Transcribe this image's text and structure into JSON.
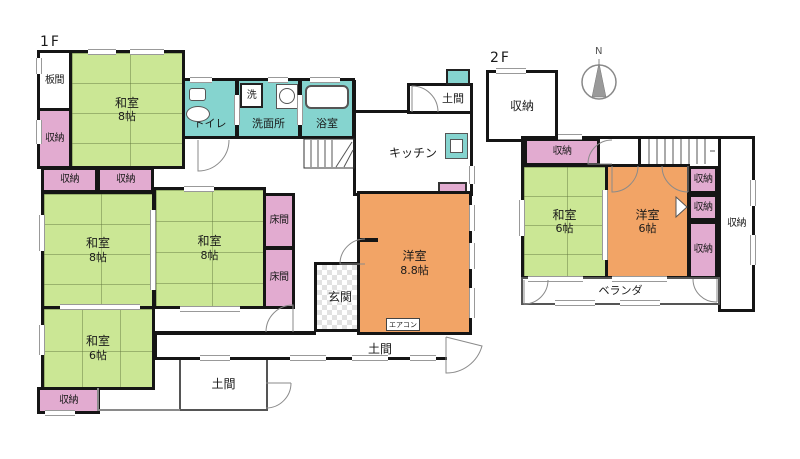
{
  "floor1": {
    "label": "1F",
    "rooms": {
      "itanoma": {
        "name": "板間"
      },
      "washitsu8_top": {
        "name": "和室",
        "size": "8帖"
      },
      "storage_left": {
        "name": "収納"
      },
      "toilet": {
        "name": "トイレ"
      },
      "laundry": {
        "name": "洗"
      },
      "washroom": {
        "name": "洗面所"
      },
      "bathroom": {
        "name": "浴室"
      },
      "kitchen": {
        "name": "キッチン"
      },
      "doma_entry": {
        "name": "土間"
      },
      "storage_a": {
        "name": "収納"
      },
      "storage_b": {
        "name": "収納"
      },
      "washitsu8_left": {
        "name": "和室",
        "size": "8帖"
      },
      "washitsu8_right": {
        "name": "和室",
        "size": "8帖"
      },
      "tokonoma_a": {
        "name": "床間"
      },
      "tokonoma_b": {
        "name": "床間"
      },
      "washitsu6": {
        "name": "和室",
        "size": "6帖"
      },
      "storage_bottom": {
        "name": "収納"
      },
      "genkan": {
        "name": "玄関"
      },
      "storage_genkan": {
        "name": "収納"
      },
      "western_room": {
        "name": "洋室",
        "size": "8.8帖"
      },
      "aircon": {
        "name": "エアコン"
      },
      "doma_box": {
        "name": "土間"
      },
      "doma_strip": {
        "name": "土間"
      }
    }
  },
  "floor2": {
    "label": "2F",
    "rooms": {
      "storage_annex": {
        "name": "収納"
      },
      "storage_top": {
        "name": "収納"
      },
      "washitsu6": {
        "name": "和室",
        "size": "6帖"
      },
      "western_room": {
        "name": "洋室",
        "size": "6帖"
      },
      "storage_right_1": {
        "name": "収納"
      },
      "storage_right_2": {
        "name": "収納"
      },
      "storage_right_3": {
        "name": "収納"
      },
      "storage_tall": {
        "name": "収納"
      },
      "veranda": {
        "name": "ベランダ"
      }
    }
  },
  "compass": {
    "label": "N"
  },
  "colors": {
    "tatami_room": "#cbe795",
    "storage": "#e2abd0",
    "wet_area": "#85d4cf",
    "western_room": "#f2a466",
    "wall": "#151515"
  }
}
